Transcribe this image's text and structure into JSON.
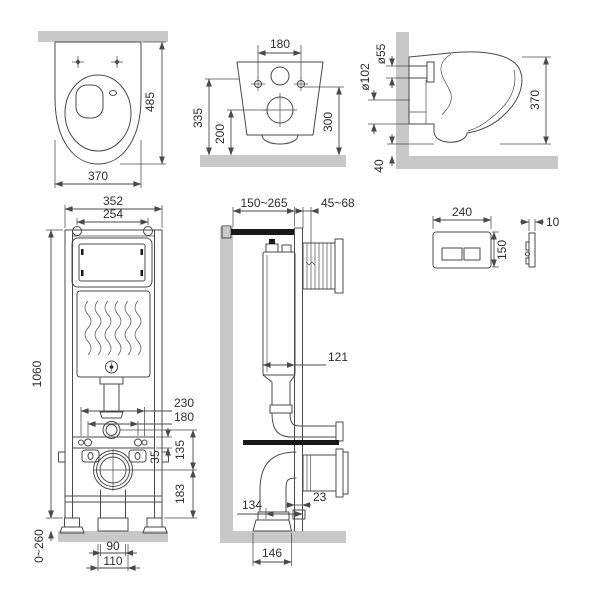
{
  "colors": {
    "line": "#4a4a4a",
    "surface": "#c8c8c8",
    "text": "#2e2e2e",
    "hardware": "#181818"
  },
  "views": {
    "toilet_top": {
      "dims": {
        "depth": "485",
        "width": "370"
      }
    },
    "toilet_rear": {
      "dims": {
        "bolt_spacing": "180",
        "inlet_height": "335",
        "outlet_height": "200",
        "fixing_height": "300"
      }
    },
    "toilet_side": {
      "dims": {
        "inlet_diameter": "ø55",
        "outlet_diameter": "ø102",
        "height": "370",
        "floor_clearance": "40"
      }
    },
    "frame_front": {
      "dims": {
        "width": "352",
        "hanger_spacing": "254",
        "height": "1060",
        "outer_stud_spacing": "230",
        "stud_spacing": "180",
        "rail_height": "35",
        "flush_to_outlet": "135",
        "outlet_to_base": "183",
        "leg_adjustment": "0~260",
        "drain_inner": "90",
        "drain_outer": "110"
      }
    },
    "frame_side": {
      "dims": {
        "install_depth": "150~265",
        "plate_depth": "45~68",
        "tank_depth": "121",
        "profile_depth": "23",
        "drain_offset": "134",
        "base_width": "146"
      }
    },
    "flush_plate": {
      "front": {
        "width": "240",
        "height": "150"
      },
      "side": {
        "thickness": "10"
      }
    }
  }
}
